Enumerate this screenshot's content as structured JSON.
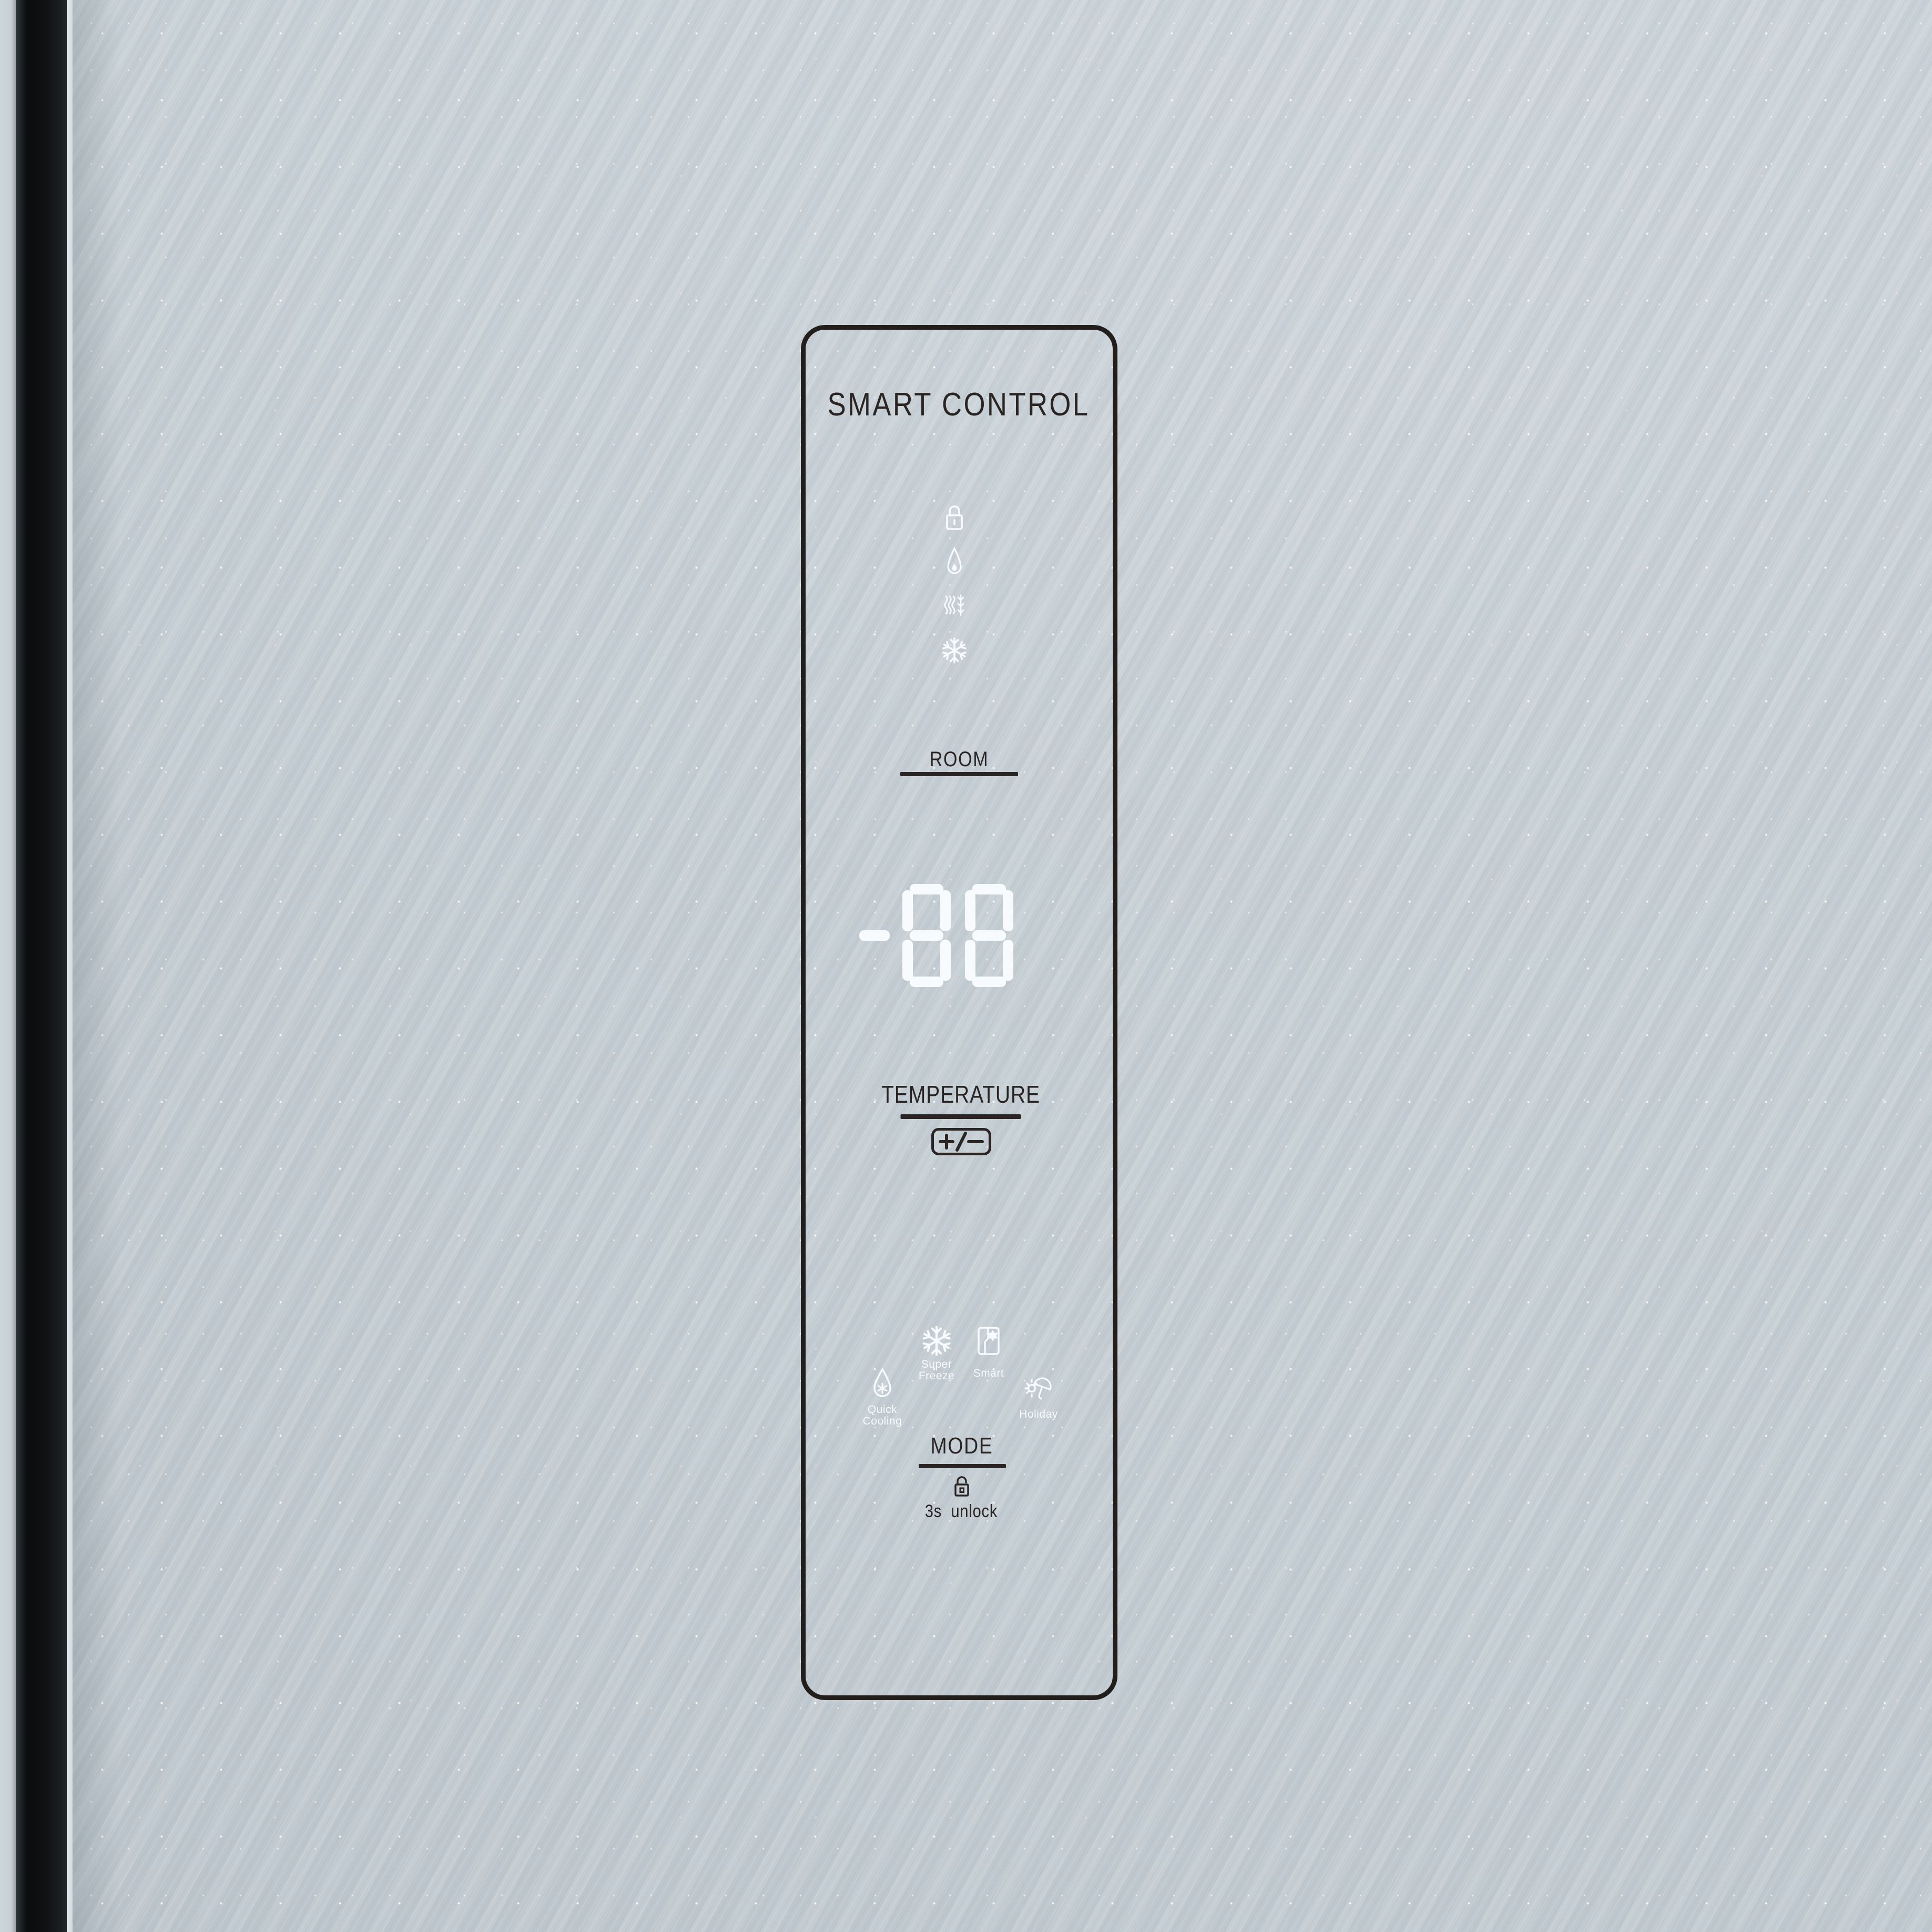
{
  "panel": {
    "title": "SMART CONTROL",
    "status_icons": [
      {
        "icon": "lock"
      },
      {
        "icon": "water-drop"
      },
      {
        "icon": "defrost"
      },
      {
        "icon": "snowflake"
      }
    ],
    "room": {
      "label": "ROOM"
    },
    "display": {
      "value": "-88"
    },
    "temperature": {
      "label": "TEMPERATURE",
      "button_label": "+/−"
    },
    "modes": [
      {
        "id": "quick-cooling",
        "icon": "droplet-snowflake",
        "lines": [
          "Quick",
          "Cooling"
        ]
      },
      {
        "id": "super-freeze",
        "icon": "snowflake",
        "lines": [
          "Super",
          "Freeze"
        ]
      },
      {
        "id": "smart",
        "icon": "fridge-star",
        "lines": [
          "Smart"
        ]
      },
      {
        "id": "holiday",
        "icon": "sun-umbrella",
        "lines": [
          "Holiday"
        ]
      }
    ],
    "mode": {
      "label": "MODE",
      "unlock_icon": "unlock-open",
      "unlock_hint": "3s unlock"
    }
  },
  "colors": {
    "door_surface": "#c6cfd5",
    "door_seam": "#0e1011",
    "panel_outline": "#221e1b",
    "printed_text": "#2a2523",
    "led_white": "#f7fbfd"
  }
}
